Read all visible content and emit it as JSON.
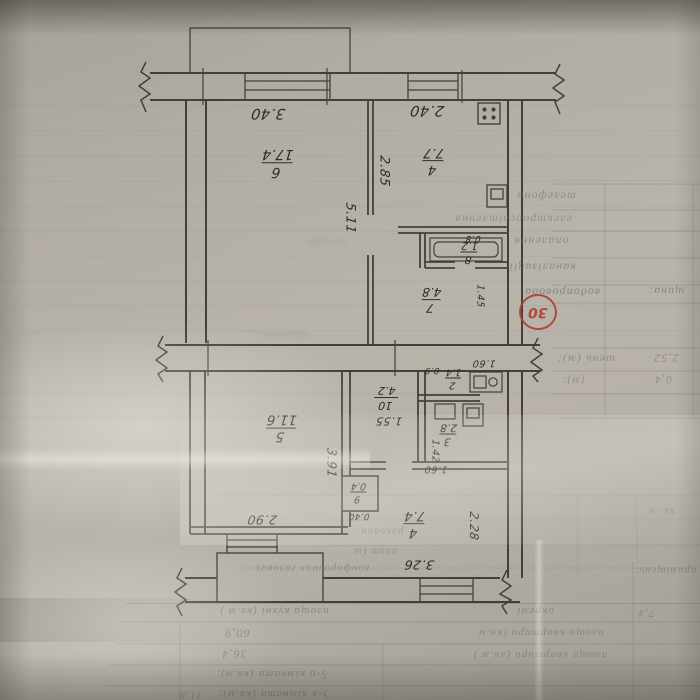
{
  "photo": {
    "paper_color": "#b7b2a9",
    "ink_color": "#3b372f",
    "stamp_color": "#b33a2d",
    "description_orientation": "document photographed upside down"
  },
  "stamp": {
    "text": "30"
  },
  "upper_plan": {
    "rooms": {
      "living": {
        "number": "6",
        "area": "17.4"
      },
      "kitchen": {
        "number": "4",
        "area": "7.7"
      },
      "hall": {
        "number": "7",
        "area": "4.8"
      },
      "bath": {
        "number": "8",
        "area": "1.2"
      }
    },
    "dims": {
      "win_left": "3.40",
      "win_right": "2.40",
      "depth_left": "5.11",
      "kitchen_depth": "2.85",
      "door": "0.8",
      "hall_w": "1.45"
    }
  },
  "lower_plan": {
    "rooms": {
      "living1": {
        "number": "5",
        "area": "11.6"
      },
      "corridor": {
        "number": "10",
        "area": "4.2"
      },
      "closet": {
        "number": "9",
        "area": "0.4"
      },
      "bath": {
        "number": "3",
        "area": "2.8"
      },
      "wc": {
        "number": "2",
        "area": "1.4"
      },
      "living2": {
        "number": "4",
        "area": "7.4"
      }
    },
    "dims": {
      "room5_w": "2.90",
      "room5_d": "3.91",
      "corr_w": "1.55",
      "closet_w": "0.40",
      "bath_d": "1.42",
      "bath_w": "1.60",
      "wc_w": "0.9",
      "wc_d": "1.60",
      "room4_w": "3.26",
      "room4_d": "2.28"
    }
  },
  "form": {
    "section_label": "щина:",
    "utilities": {
      "water": "водопровода",
      "sewer": "каналізації",
      "heating": "опалення",
      "electric": "електроосвітлення",
      "phone": "телефона"
    },
    "height_label": "шень (м):",
    "height_value": "2,52",
    "row2_label": "(м):",
    "row2_value": "0,4",
    "frag_kvm": "кв. м",
    "frag_sinks": "раковин",
    "frag_stoves": "плит (ш",
    "frag_burners": "конфорочних газових",
    "frag_premises": "приміщень:",
    "kitchen_row": {
      "label": "площа кухні (кв.м )",
      "mid": "окремі",
      "value": "7,4"
    },
    "total_row": {
      "label": "площа квартири (кв.м",
      "value": "60,9"
    },
    "living_row": {
      "label": "площа квартири (кв.м )",
      "value": "36,4"
    },
    "room5_row": {
      "label": "5-а кімната (кв.м):"
    },
    "room3_row": {
      "label": "3-я кімната (кв.м):",
      "value": "11,8"
    },
    "ghosts": {
      "a": "ономи",
      "b": "орочних"
    }
  }
}
